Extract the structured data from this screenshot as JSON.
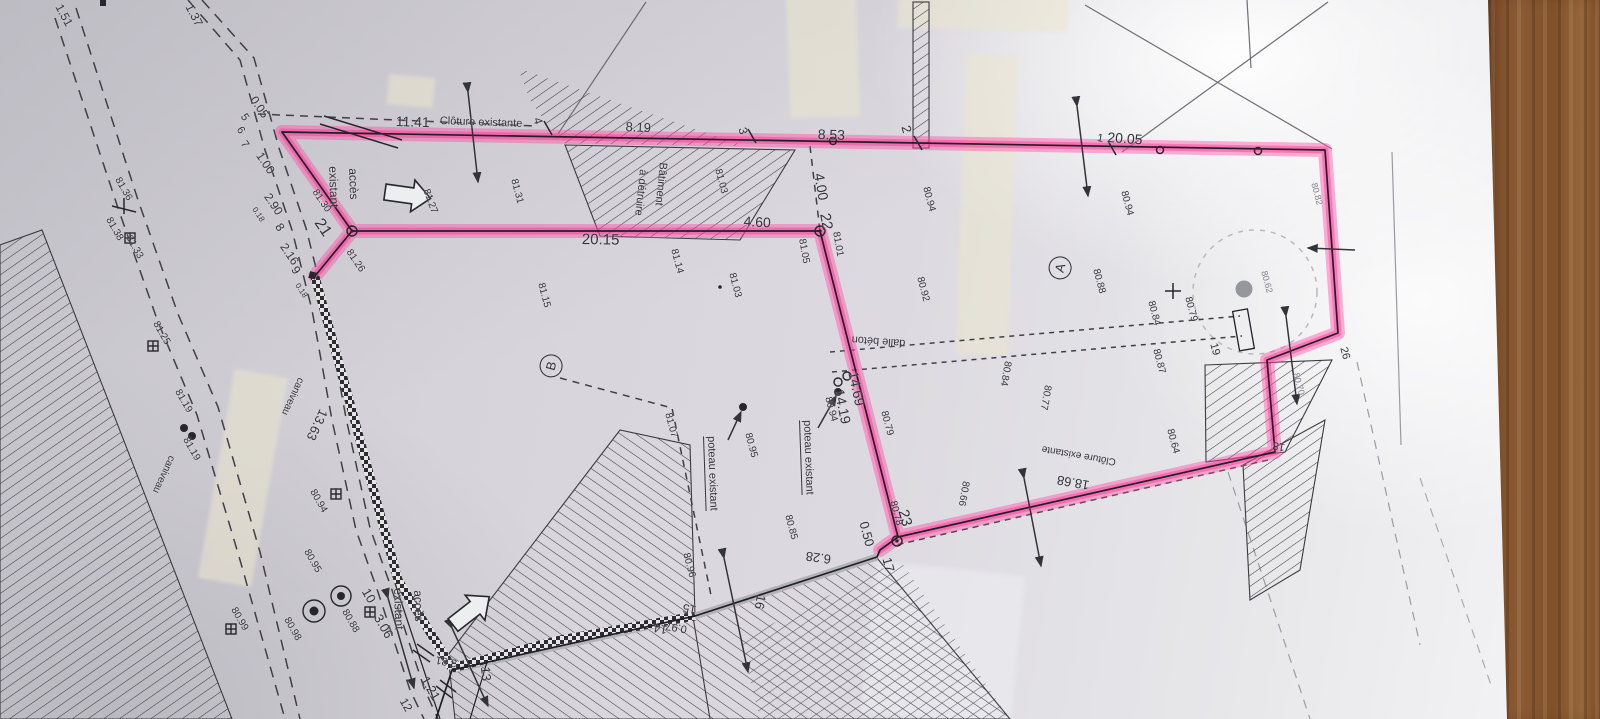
{
  "colors": {
    "highlight": "#ff3d9c",
    "paper": "#d8d6dc",
    "wood": "#8a5a35",
    "ink": "#2b2b30"
  },
  "plan": {
    "labels": [
      {
        "t": "1.51",
        "x": 64,
        "y": 2,
        "r": 62,
        "s": 12
      },
      {
        "t": "1.37",
        "x": 194,
        "y": 2,
        "r": 62,
        "s": 12
      },
      {
        "t": "0.05",
        "x": 258,
        "y": 94,
        "r": 56,
        "s": 12
      },
      {
        "t": "5",
        "x": 247,
        "y": 112,
        "r": 56,
        "s": 11
      },
      {
        "t": "6",
        "x": 243,
        "y": 125,
        "r": 56,
        "s": 11
      },
      {
        "t": "7",
        "x": 247,
        "y": 139,
        "r": 56,
        "s": 11
      },
      {
        "t": "1.00",
        "x": 264,
        "y": 150,
        "r": 56,
        "s": 12
      },
      {
        "t": "2.90",
        "x": 272,
        "y": 191,
        "r": 56,
        "s": 12
      },
      {
        "t": "0.18",
        "x": 257,
        "y": 206,
        "r": 56,
        "s": 8
      },
      {
        "t": "8",
        "x": 283,
        "y": 221,
        "r": 56,
        "s": 12
      },
      {
        "t": "2.16",
        "x": 288,
        "y": 241,
        "r": 56,
        "s": 12
      },
      {
        "t": "9",
        "x": 299,
        "y": 264,
        "r": 56,
        "s": 12
      },
      {
        "t": "0.18",
        "x": 300,
        "y": 282,
        "r": 56,
        "s": 8
      },
      {
        "t": "21",
        "x": 324,
        "y": 216,
        "r": 56,
        "s": 16
      },
      {
        "t": "81.30",
        "x": 318,
        "y": 188,
        "r": 56,
        "s": 10
      },
      {
        "t": "81.26",
        "x": 352,
        "y": 248,
        "r": 56,
        "s": 10
      },
      {
        "t": "accès",
        "x": 359,
        "y": 168,
        "r": 88,
        "s": 12
      },
      {
        "t": "existant",
        "x": 339,
        "y": 166,
        "r": 88,
        "s": 12
      },
      {
        "t": "81.27",
        "x": 430,
        "y": 188,
        "r": 70,
        "s": 10
      },
      {
        "t": "11.41",
        "x": 396,
        "y": 114,
        "r": 2,
        "s": 14
      },
      {
        "t": "Clôture existante",
        "x": 440,
        "y": 116,
        "r": 2,
        "s": 11
      },
      {
        "t": "4",
        "x": 543,
        "y": 116,
        "r": 75,
        "s": 12
      },
      {
        "t": "81.31",
        "x": 518,
        "y": 178,
        "r": 75,
        "s": 10
      },
      {
        "t": "81.15",
        "x": 545,
        "y": 282,
        "r": 75,
        "s": 10
      },
      {
        "t": "8.19",
        "x": 626,
        "y": 120,
        "r": 3,
        "s": 13
      },
      {
        "t": "Bâtiment",
        "x": 668,
        "y": 163,
        "r": 96,
        "s": 11
      },
      {
        "t": "à détruire",
        "x": 648,
        "y": 170,
        "r": 96,
        "s": 11
      },
      {
        "t": "3",
        "x": 748,
        "y": 126,
        "r": 75,
        "s": 12
      },
      {
        "t": "81.03",
        "x": 722,
        "y": 168,
        "r": 75,
        "s": 10
      },
      {
        "t": "81.14",
        "x": 678,
        "y": 248,
        "r": 75,
        "s": 10
      },
      {
        "t": "81.03",
        "x": 736,
        "y": 272,
        "r": 75,
        "s": 10
      },
      {
        "t": "8.53",
        "x": 818,
        "y": 127,
        "r": 2,
        "s": 14
      },
      {
        "t": "2",
        "x": 912,
        "y": 124,
        "r": 75,
        "s": 13
      },
      {
        "t": "20.15",
        "x": 582,
        "y": 232,
        "r": 1,
        "s": 15
      },
      {
        "t": "4.60",
        "x": 744,
        "y": 214,
        "r": 3,
        "s": 14
      },
      {
        "t": "4.00",
        "x": 826,
        "y": 172,
        "r": 80,
        "s": 14
      },
      {
        "t": "22",
        "x": 832,
        "y": 212,
        "r": 80,
        "s": 15
      },
      {
        "t": "81.01",
        "x": 840,
        "y": 231,
        "r": 80,
        "s": 10
      },
      {
        "t": "81.05",
        "x": 806,
        "y": 238,
        "r": 80,
        "s": 10
      },
      {
        "t": "80.94",
        "x": 930,
        "y": 186,
        "r": 75,
        "s": 10
      },
      {
        "t": "80.92",
        "x": 924,
        "y": 276,
        "r": 75,
        "s": 10
      },
      {
        "t": "20.05",
        "x": 1108,
        "y": 130,
        "r": 4,
        "s": 14
      },
      {
        "t": "1",
        "x": 1098,
        "y": 133,
        "r": 10,
        "s": 11
      },
      {
        "t": "80.94",
        "x": 1128,
        "y": 190,
        "r": 75,
        "s": 10
      },
      {
        "t": "80.88",
        "x": 1100,
        "y": 268,
        "r": 75,
        "s": 10
      },
      {
        "t": "A",
        "x": 1046,
        "y": 276,
        "r": -75,
        "s": 13,
        "c": "circ"
      },
      {
        "t": "80.84",
        "x": 1155,
        "y": 300,
        "r": 75,
        "s": 10
      },
      {
        "t": "80.79",
        "x": 1192,
        "y": 296,
        "r": 75,
        "s": 10
      },
      {
        "t": "80.82",
        "x": 1318,
        "y": 182,
        "r": 75,
        "s": 9,
        "c": "faint"
      },
      {
        "t": "80.62",
        "x": 1268,
        "y": 270,
        "r": 75,
        "s": 9,
        "c": "faint"
      },
      {
        "t": "80.70",
        "x": 1300,
        "y": 372,
        "r": 75,
        "s": 9,
        "c": "faint"
      },
      {
        "t": "80.84",
        "x": 1012,
        "y": 362,
        "r": 100,
        "s": 10
      },
      {
        "t": "80.77",
        "x": 1052,
        "y": 386,
        "r": 100,
        "s": 10
      },
      {
        "t": "80.87",
        "x": 1160,
        "y": 348,
        "r": 75,
        "s": 10
      },
      {
        "t": "80.64",
        "x": 1174,
        "y": 428,
        "r": 75,
        "s": 10
      },
      {
        "t": "19",
        "x": 1218,
        "y": 342,
        "r": 75,
        "s": 11
      },
      {
        "t": "26",
        "x": 1348,
        "y": 346,
        "r": 75,
        "s": 11
      },
      {
        "t": "18",
        "x": 1284,
        "y": 452,
        "r": 190,
        "s": 11
      },
      {
        "t": "dalle béton",
        "x": 905,
        "y": 348,
        "r": 184,
        "s": 11
      },
      {
        "t": "14.69",
        "x": 860,
        "y": 370,
        "r": 78,
        "s": 14
      },
      {
        "t": "14.19",
        "x": 846,
        "y": 388,
        "r": 78,
        "s": 14
      },
      {
        "t": "80.94",
        "x": 832,
        "y": 396,
        "r": 75,
        "s": 10
      },
      {
        "t": "80.79",
        "x": 888,
        "y": 410,
        "r": 75,
        "s": 10
      },
      {
        "t": "B",
        "x": 537,
        "y": 374,
        "r": -75,
        "s": 13,
        "c": "circ"
      },
      {
        "t": "poteau existant",
        "x": 716,
        "y": 436,
        "r": 88,
        "s": 11,
        "c": "ul"
      },
      {
        "t": "poteau existant",
        "x": 812,
        "y": 420,
        "r": 88,
        "s": 11,
        "c": "ul"
      },
      {
        "t": "81.07",
        "x": 672,
        "y": 412,
        "r": 75,
        "s": 10
      },
      {
        "t": "80.95",
        "x": 752,
        "y": 432,
        "r": 75,
        "s": 10
      },
      {
        "t": "80.85",
        "x": 792,
        "y": 514,
        "r": 75,
        "s": 10
      },
      {
        "t": "80.96",
        "x": 690,
        "y": 552,
        "r": 75,
        "s": 10
      },
      {
        "t": "80.66",
        "x": 970,
        "y": 482,
        "r": 100,
        "s": 10
      },
      {
        "t": "80.78",
        "x": 897,
        "y": 500,
        "r": 75,
        "s": 10
      },
      {
        "t": "23",
        "x": 910,
        "y": 508,
        "r": 75,
        "s": 15
      },
      {
        "t": "0.50",
        "x": 870,
        "y": 520,
        "r": 75,
        "s": 13
      },
      {
        "t": "17",
        "x": 893,
        "y": 556,
        "r": 75,
        "s": 13
      },
      {
        "t": "18.68",
        "x": 1088,
        "y": 492,
        "r": 190,
        "s": 13
      },
      {
        "t": "Clôture existante",
        "x": 1115,
        "y": 466,
        "r": 190,
        "s": 10
      },
      {
        "t": "6.28",
        "x": 830,
        "y": 566,
        "r": 188,
        "s": 13
      },
      {
        "t": "16",
        "x": 768,
        "y": 596,
        "r": 100,
        "s": 13
      },
      {
        "t": "15",
        "x": 695,
        "y": 616,
        "r": 190,
        "s": 12
      },
      {
        "t": "0.97",
        "x": 686,
        "y": 634,
        "r": 190,
        "s": 11
      },
      {
        "t": "14",
        "x": 666,
        "y": 636,
        "r": 190,
        "s": 12
      },
      {
        "t": "13",
        "x": 492,
        "y": 666,
        "r": 85,
        "s": 13
      },
      {
        "t": "3.81",
        "x": 456,
        "y": 668,
        "r": 190,
        "s": 11
      },
      {
        "t": "accès",
        "x": 424,
        "y": 590,
        "r": 88,
        "s": 12
      },
      {
        "t": "existant",
        "x": 404,
        "y": 588,
        "r": 88,
        "s": 12
      },
      {
        "t": "10",
        "x": 371,
        "y": 586,
        "r": 60,
        "s": 13
      },
      {
        "t": "3.06",
        "x": 383,
        "y": 612,
        "r": 60,
        "s": 13
      },
      {
        "t": "1.21",
        "x": 430,
        "y": 674,
        "r": 60,
        "s": 13
      },
      {
        "t": "12",
        "x": 408,
        "y": 696,
        "r": 60,
        "s": 12
      },
      {
        "t": "80.88",
        "x": 348,
        "y": 608,
        "r": 60,
        "s": 10
      },
      {
        "t": "80.95",
        "x": 310,
        "y": 548,
        "r": 60,
        "s": 10
      },
      {
        "t": "80.98",
        "x": 290,
        "y": 616,
        "r": 60,
        "s": 10
      },
      {
        "t": "80.99",
        "x": 237,
        "y": 606,
        "r": 60,
        "s": 10
      },
      {
        "t": "80.94",
        "x": 316,
        "y": 488,
        "r": 60,
        "s": 10
      },
      {
        "t": "13.63",
        "x": 330,
        "y": 413,
        "r": 115,
        "s": 13
      },
      {
        "t": "caniveau",
        "x": 305,
        "y": 380,
        "r": 115,
        "s": 10
      },
      {
        "t": "caniveau",
        "x": 176,
        "y": 458,
        "r": 115,
        "s": 10
      },
      {
        "t": "81.19",
        "x": 181,
        "y": 388,
        "r": 60,
        "s": 10
      },
      {
        "t": "81.19",
        "x": 189,
        "y": 436,
        "r": 60,
        "s": 10
      },
      {
        "t": "81.25",
        "x": 159,
        "y": 320,
        "r": 60,
        "s": 10
      },
      {
        "t": "81.33",
        "x": 132,
        "y": 234,
        "r": 60,
        "s": 10
      },
      {
        "t": "81.38",
        "x": 112,
        "y": 216,
        "r": 60,
        "s": 10
      },
      {
        "t": "81.36",
        "x": 121,
        "y": 176,
        "r": 60,
        "s": 10
      }
    ]
  }
}
